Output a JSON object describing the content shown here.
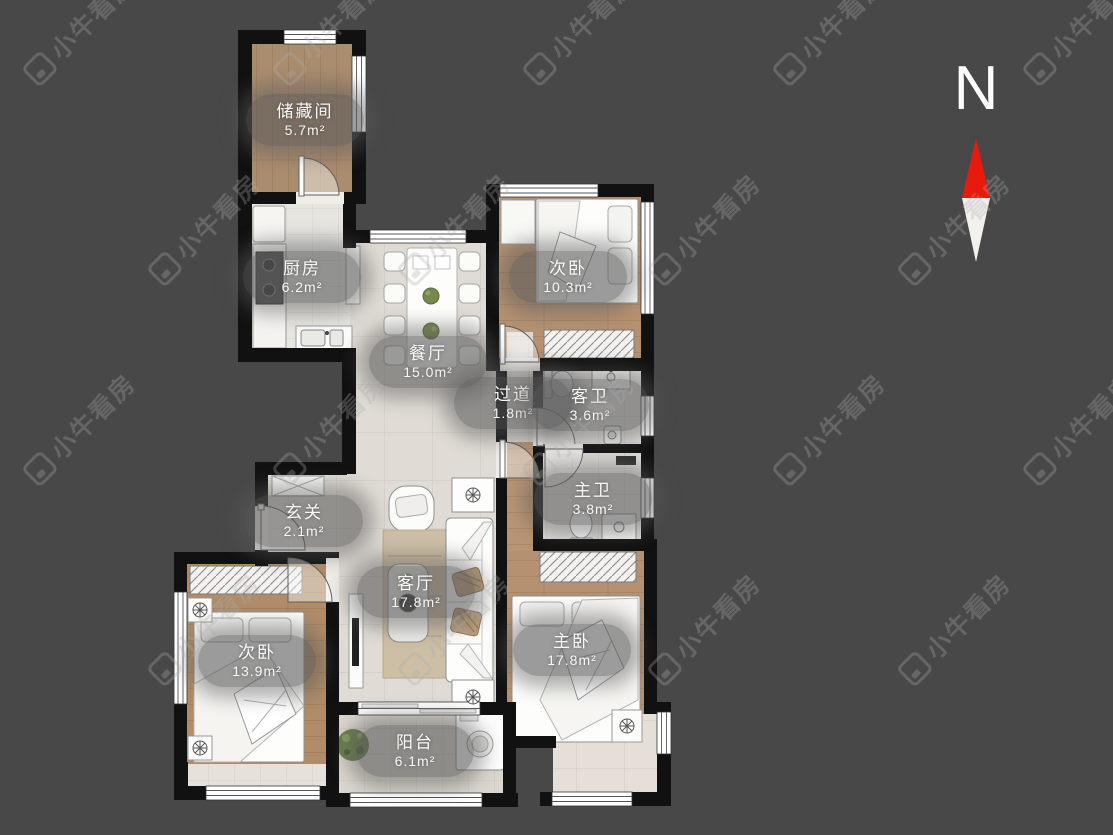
{
  "watermark": {
    "text": "小牛看房"
  },
  "compass": {
    "label": "N"
  },
  "colors": {
    "background": "#484848",
    "wall": "#111111",
    "compass_red": "#e8190d",
    "compass_white": "#f3f1ee",
    "label_text": "#f7f7f7"
  },
  "rooms": [
    {
      "id": "storage",
      "name": "储藏间",
      "area": "5.7m²"
    },
    {
      "id": "kitchen",
      "name": "厨房",
      "area": "6.2m²"
    },
    {
      "id": "bedroom-top",
      "name": "次卧",
      "area": "10.3m²"
    },
    {
      "id": "dining",
      "name": "餐厅",
      "area": "15.0m²"
    },
    {
      "id": "hallway",
      "name": "过道",
      "area": "1.8m²"
    },
    {
      "id": "guest-bath",
      "name": "客卫",
      "area": "3.6m²"
    },
    {
      "id": "master-bath",
      "name": "主卫",
      "area": "3.8m²"
    },
    {
      "id": "entry",
      "name": "玄关",
      "area": "2.1m²"
    },
    {
      "id": "living",
      "name": "客厅",
      "area": "17.8m²"
    },
    {
      "id": "bedroom-left",
      "name": "次卧",
      "area": "13.9m²"
    },
    {
      "id": "master-bedroom",
      "name": "主卧",
      "area": "17.8m²"
    },
    {
      "id": "balcony",
      "name": "阳台",
      "area": "6.1m²"
    }
  ]
}
